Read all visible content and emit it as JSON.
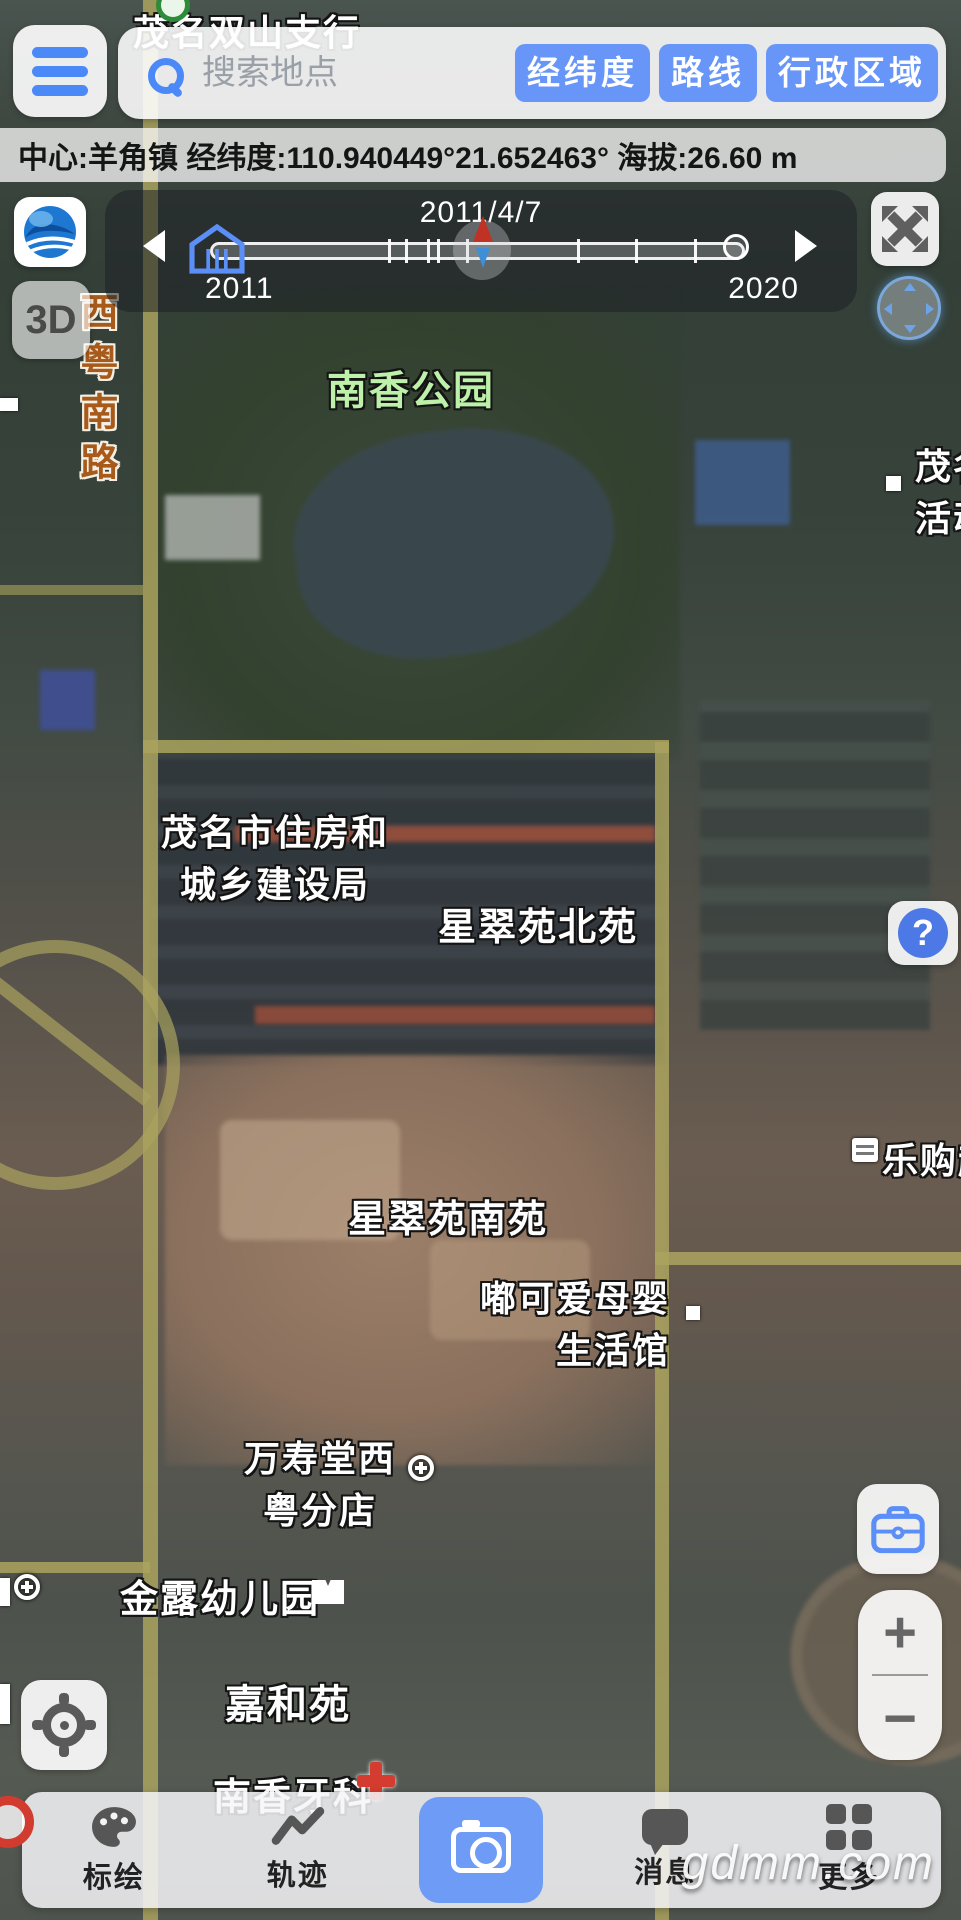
{
  "search": {
    "placeholder": "搜索地点",
    "buttons": [
      "经纬度",
      "路线",
      "行政区域"
    ]
  },
  "status": {
    "text": "中心:羊角镇 经纬度:110.940449°21.652463° 海拔:26.60 m"
  },
  "timeline": {
    "date": "2011/4/7",
    "start_year": "2011",
    "end_year": "2020"
  },
  "left_controls": {
    "three_d": "3D"
  },
  "zoom_control": {
    "plus": "+",
    "minus": "−"
  },
  "right_controls": {
    "help": "?"
  },
  "map_labels": {
    "bank_branch": "茂名双山支行",
    "park": "南香公园",
    "road_vertical": "西粤南路",
    "housing_bureau": {
      "line1": "茂名市住房和",
      "line2": "城乡建设局"
    },
    "estate_north": "星翠苑北苑",
    "estate_south": "星翠苑南苑",
    "baby_shop": {
      "line1": "嘟可爱母婴",
      "line2": "生活馆"
    },
    "supermarket": "乐购超",
    "edge_poi": {
      "line1": "茂名",
      "line2": "活动"
    },
    "pharmacy": {
      "line1": "万寿堂西",
      "line2": "粤分店"
    },
    "kindergarten": "金露幼儿园",
    "residence": "嘉和苑",
    "dental": "南香牙科"
  },
  "bottom_bar": {
    "items": [
      {
        "label": "标绘"
      },
      {
        "label": "轨迹"
      },
      {
        "label": "消息"
      },
      {
        "label": "更多"
      }
    ]
  },
  "watermark": "gdmm.com",
  "icons": {
    "menu": "hamburger",
    "search": "magnifier",
    "logo": "blue-globe",
    "fullscreen": "expand-arrows",
    "compass": "compass-ring",
    "help": "question-mark",
    "toolbox": "briefcase",
    "locate": "crosshair",
    "draw": "palette",
    "track": "zigzag-line",
    "camera": "camera",
    "message": "chat-bubble",
    "more": "grid"
  },
  "colors": {
    "accent_blue": "#4c89f8",
    "button_blue": "#6896f8",
    "camera_blue": "#6d9bf5",
    "label_green": "#bdf0a8",
    "road_label_brown": "#a85a1a",
    "marker_red": "#bf3224",
    "marker_blue": "#3f8fd6"
  }
}
